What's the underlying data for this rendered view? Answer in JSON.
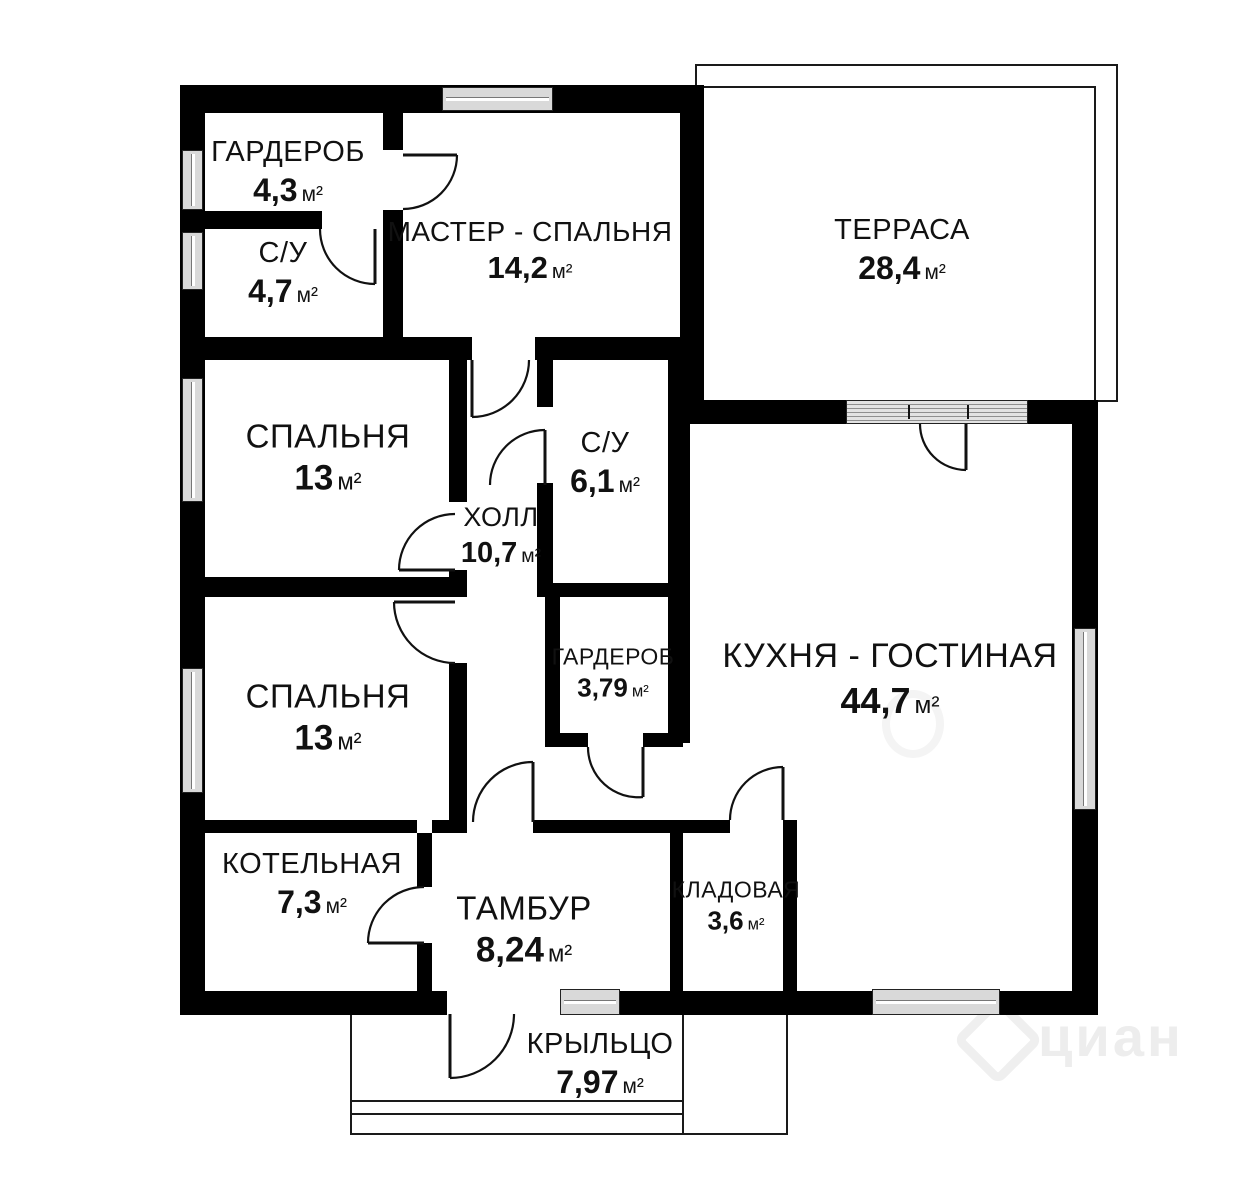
{
  "plan_title": "Одноэтажный дом — план",
  "units": {
    "sq": "м²"
  },
  "rooms": [
    {
      "id": "garderob-1",
      "name": "ГАРДЕРОБ",
      "area": "4,3",
      "unit": "м²"
    },
    {
      "id": "su-1",
      "name": "С/У",
      "area": "4,7",
      "unit": "м²"
    },
    {
      "id": "master",
      "name": "МАСТЕР - СПАЛЬНЯ",
      "area": "14,2",
      "unit": "м²"
    },
    {
      "id": "terrace",
      "name": "ТЕРРАСА",
      "area": "28,4",
      "unit": "м²"
    },
    {
      "id": "bedroom-1",
      "name": "СПАЛЬНЯ",
      "area": "13",
      "unit": "м²"
    },
    {
      "id": "su-2",
      "name": "С/У",
      "area": "6,1",
      "unit": "м²"
    },
    {
      "id": "hall",
      "name": "ХОЛЛ",
      "area": "10,7",
      "unit": "м²"
    },
    {
      "id": "garderob-2",
      "name": "ГАРДЕРОБ",
      "area": "3,79",
      "unit": "м²"
    },
    {
      "id": "kitchen",
      "name": "КУХНЯ - ГОСТИНАЯ",
      "area": "44,7",
      "unit": "м²"
    },
    {
      "id": "bedroom-2",
      "name": "СПАЛЬНЯ",
      "area": "13",
      "unit": "м²"
    },
    {
      "id": "boiler",
      "name": "КОТЕЛЬНАЯ",
      "area": "7,3",
      "unit": "м²"
    },
    {
      "id": "tambur",
      "name": "ТАМБУР",
      "area": "8,24",
      "unit": "м²"
    },
    {
      "id": "storage",
      "name": "КЛАДОВАЯ",
      "area": "3,6",
      "unit": "м²"
    },
    {
      "id": "porch",
      "name": "КРЫЛЬЦО",
      "area": "7,97",
      "unit": "м²"
    }
  ],
  "watermark": {
    "text": "циан"
  },
  "colors": {
    "wall": "#000000",
    "window_fill": "#d9d9d9",
    "window_frame": "#222222",
    "background": "#ffffff",
    "watermark": "#ededed"
  }
}
